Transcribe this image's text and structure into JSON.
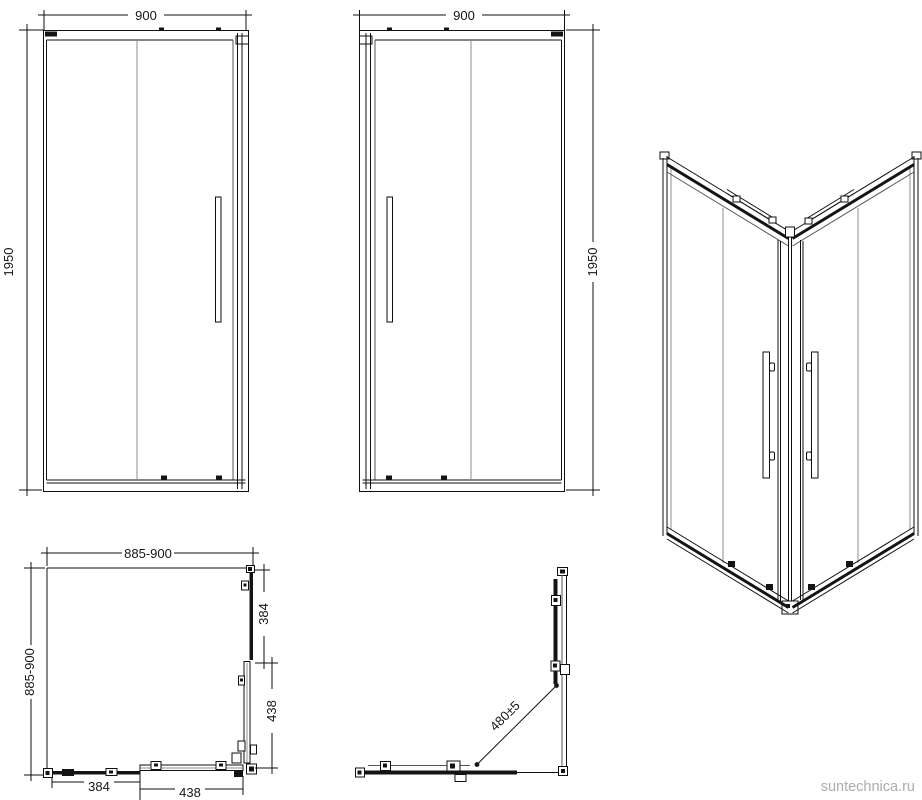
{
  "watermark": {
    "text": "suntechnica.ru",
    "color": "#acacac"
  },
  "views": {
    "front_left": {
      "width_label": "900",
      "height_label": "1950"
    },
    "front_right": {
      "width_label": "900",
      "height_label": "1950"
    },
    "plan_closed": {
      "width_label": "885-900",
      "depth_label": "885-900",
      "side_fixed_label": "384",
      "side_door_label": "438",
      "bottom_fixed_label": "384",
      "bottom_door_label": "438"
    },
    "plan_open": {
      "opening_label": "480±5"
    }
  },
  "colors": {
    "line": "#0f0f0f",
    "glass": "#8f8f8f",
    "background": "#ffffff"
  }
}
